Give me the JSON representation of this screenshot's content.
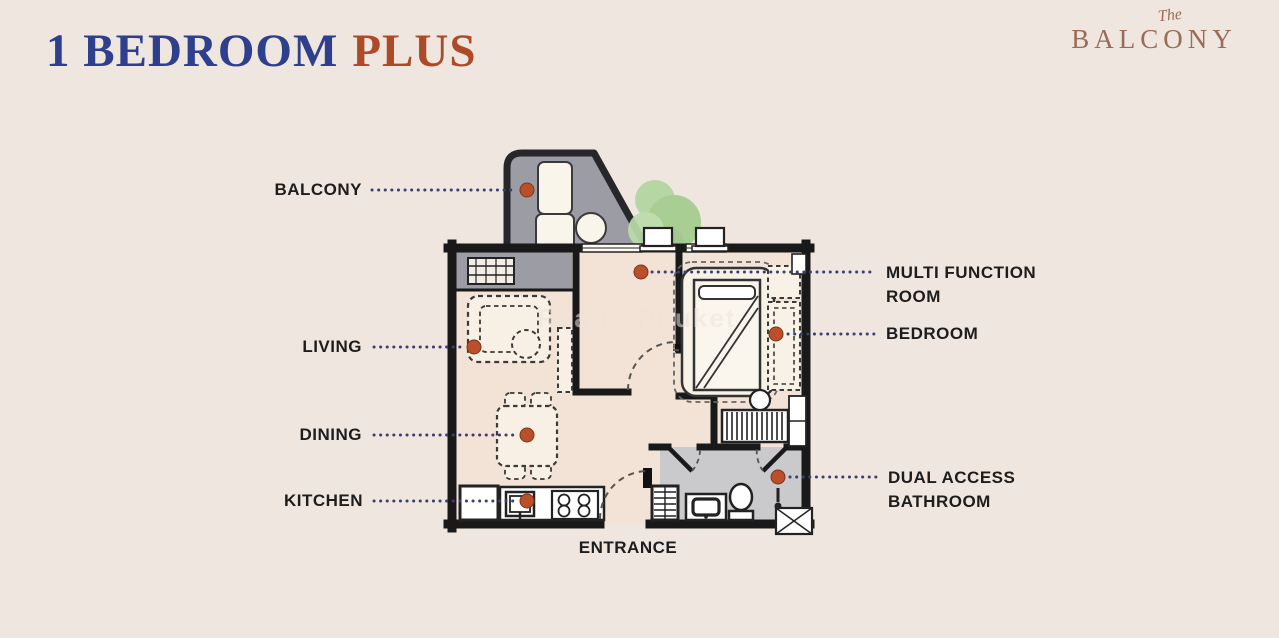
{
  "header": {
    "title": {
      "primary": "1 BEDROOM",
      "accent": "PLUS"
    },
    "brand": {
      "prefix": "The",
      "name": "BALCONY"
    }
  },
  "floor_plan": {
    "watermark": "Realty-Phuket",
    "labels": {
      "balcony": "BALCONY",
      "living": "LIVING",
      "dining": "DINING",
      "kitchen": "KITCHEN",
      "multi_function_room": "MULTI FUNCTION ROOM",
      "bedroom": "BEDROOM",
      "dual_access_bathroom": "DUAL ACCESS BATHROOM",
      "entrance": "ENTRANCE"
    }
  },
  "colors": {
    "background": "#efe6e0",
    "title_primary": "#2e3f8e",
    "title_accent": "#ad4a28",
    "brand": "#9a6b55",
    "label_text": "#1d1d1d",
    "leader_dot": "#3b4070",
    "marker_dot": "#b9502a",
    "wall": "#191919",
    "interior_floor": "#f3e3d6",
    "balcony_floor": "#9b9ca4",
    "bathroom_floor": "#cacacd",
    "plant_green": "#a9d095"
  }
}
